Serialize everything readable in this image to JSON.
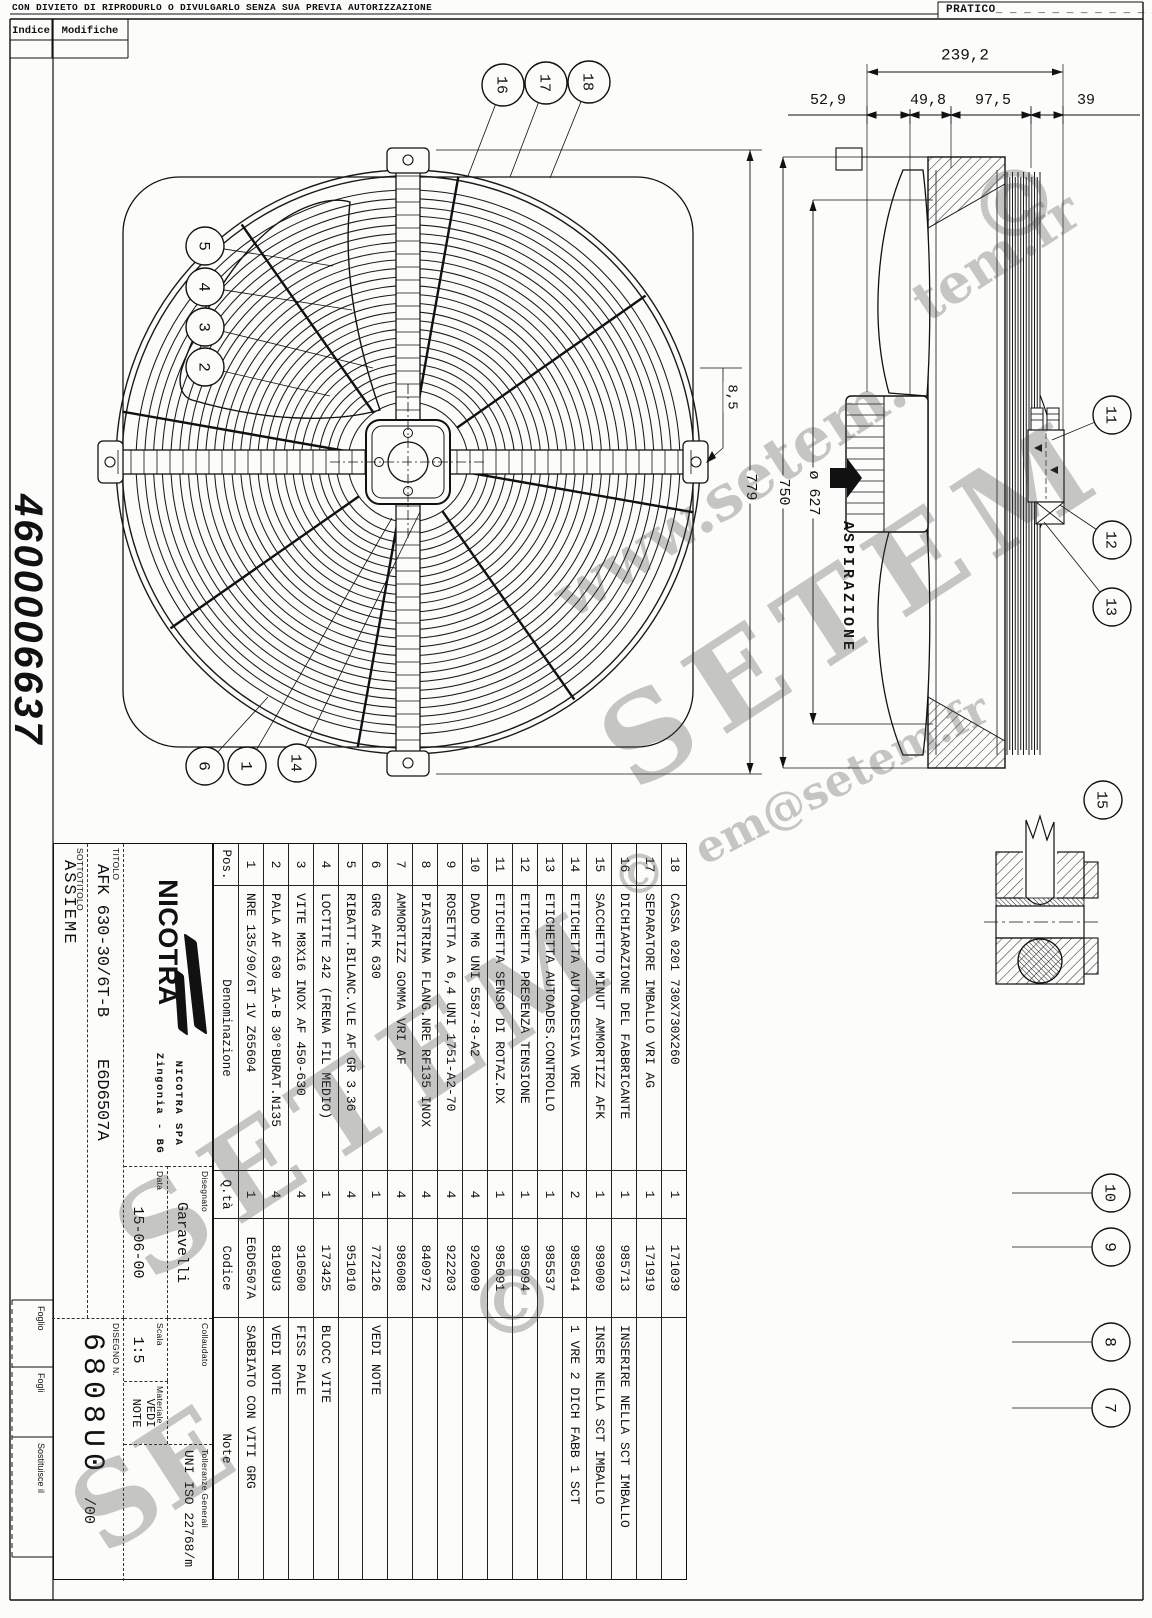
{
  "sheet": {
    "disclaimer": "CON DIVIETO DI RIPRODURLO O DIVULGARLO SENZA SUA PREVIA AUTORIZZAZIONE",
    "pratico": "PRATICO_ _ _ _ _ _ _ _ _ _ _ _",
    "indice_header": "Indice",
    "modifiche_header": "Modifiche",
    "drawing_number_side": "4600006637",
    "foglio_label": "Foglio",
    "fogli_label": "Fogli",
    "sostituisce_label": "Sostituisce il"
  },
  "views": {
    "aspirazione_label": "ASPIRAZIONE"
  },
  "dimensions": [
    {
      "text": "239,2",
      "x": 965,
      "y": 56,
      "rot": 0,
      "size": 16
    },
    {
      "text": "52,9",
      "x": 828,
      "y": 101,
      "rot": 0,
      "size": 15
    },
    {
      "text": "49,8",
      "x": 928,
      "y": 101,
      "rot": 0,
      "size": 15
    },
    {
      "text": "97,5",
      "x": 993,
      "y": 101,
      "rot": 0,
      "size": 15
    },
    {
      "text": "39",
      "x": 1086,
      "y": 101,
      "rot": 0,
      "size": 15
    },
    {
      "text": "779",
      "x": 750,
      "y": 487,
      "rot": 90,
      "size": 15
    },
    {
      "text": "750",
      "x": 783,
      "y": 492,
      "rot": 90,
      "size": 15
    },
    {
      "text": "ø 627",
      "x": 813,
      "y": 493,
      "rot": 90,
      "size": 15
    },
    {
      "text": "8,5",
      "x": 731,
      "y": 397,
      "rot": 90,
      "size": 14
    }
  ],
  "balloons": [
    {
      "n": "1",
      "x": 247,
      "y": 766,
      "tx": 392,
      "ty": 518
    },
    {
      "n": "2",
      "x": 205,
      "y": 367,
      "tx": 330,
      "ty": 396
    },
    {
      "n": "3",
      "x": 205,
      "y": 327,
      "tx": 373,
      "ty": 368
    },
    {
      "n": "4",
      "x": 205,
      "y": 287,
      "tx": 352,
      "ty": 310
    },
    {
      "n": "5",
      "x": 205,
      "y": 246,
      "tx": 333,
      "ty": 266
    },
    {
      "n": "6",
      "x": 205,
      "y": 766,
      "tx": 268,
      "ty": 697
    },
    {
      "n": "7",
      "x": 1111,
      "y": 1408,
      "tx": 1012,
      "ty": 1408
    },
    {
      "n": "8",
      "x": 1111,
      "y": 1342,
      "tx": 1012,
      "ty": 1342
    },
    {
      "n": "9",
      "x": 1111,
      "y": 1247,
      "tx": 1012,
      "ty": 1247
    },
    {
      "n": "10",
      "x": 1111,
      "y": 1193,
      "tx": 1012,
      "ty": 1193
    },
    {
      "n": "11",
      "x": 1112,
      "y": 415,
      "tx": 1052,
      "ty": 440
    },
    {
      "n": "12",
      "x": 1112,
      "y": 540,
      "tx": 1060,
      "ty": 505
    },
    {
      "n": "13",
      "x": 1112,
      "y": 607,
      "tx": 1044,
      "ty": 522
    },
    {
      "n": "14",
      "x": 297,
      "y": 763,
      "tx": 420,
      "ty": 512
    },
    {
      "n": "15",
      "x": 1103,
      "y": 800
    },
    {
      "n": "16",
      "x": 503,
      "y": 85,
      "tx": 468,
      "ty": 176,
      "r": 21
    },
    {
      "n": "17",
      "x": 546,
      "y": 83,
      "tx": 510,
      "ty": 177,
      "r": 21
    },
    {
      "n": "18",
      "x": 589,
      "y": 82,
      "tx": 550,
      "ty": 178,
      "r": 21
    }
  ],
  "bom": {
    "headers": {
      "pos": "Pos.",
      "den": "Denominazione",
      "qty": "Q.tà",
      "code": "Codice",
      "note": "Note"
    },
    "rows": [
      {
        "pos": "1",
        "den": "NRE 135/90/6T 1V Z65604",
        "qty": "1",
        "code": "E6D6507A",
        "note": "SABBIATO CON VITI GRG"
      },
      {
        "pos": "2",
        "den": "PALA AF 630 1A-B 30°BURAT.N135",
        "qty": "4",
        "code": "8109U3",
        "note": "VEDI NOTE"
      },
      {
        "pos": "3",
        "den": "VITE M8X16 INOX AF 450-630",
        "qty": "4",
        "code": "910500",
        "note": "FISS PALE"
      },
      {
        "pos": "4",
        "den": "LOCTITE 242 (FRENA FIL MEDIO)",
        "qty": "1",
        "code": "173425",
        "note": "BLOCC VITE"
      },
      {
        "pos": "5",
        "den": "RIBATT.BILANC.VLE AF GR 3.36",
        "qty": "4",
        "code": "951010",
        "note": ""
      },
      {
        "pos": "6",
        "den": "GRG AFK 630",
        "qty": "1",
        "code": "772126",
        "note": "VEDI NOTE"
      },
      {
        "pos": "7",
        "den": "AMMORTIZZ GOMMA VRI AF",
        "qty": "4",
        "code": "986008",
        "note": ""
      },
      {
        "pos": "8",
        "den": "PIASTRINA FLANG.NRE RF135 INOX",
        "qty": "4",
        "code": "840972",
        "note": ""
      },
      {
        "pos": "9",
        "den": "ROSETTA A 6,4 UNI 1751-A2-70",
        "qty": "4",
        "code": "922203",
        "note": ""
      },
      {
        "pos": "10",
        "den": "DADO M6 UNI 5587-8-A2",
        "qty": "4",
        "code": "920009",
        "note": ""
      },
      {
        "pos": "11",
        "den": "ETICHETTA SENSO DI ROTAZ.DX",
        "qty": "1",
        "code": "985091",
        "note": ""
      },
      {
        "pos": "12",
        "den": "ETICHETTA PRESENZA TENSIONE",
        "qty": "1",
        "code": "985094",
        "note": ""
      },
      {
        "pos": "13",
        "den": "ETICHETTA AUTOADES.CONTROLLO",
        "qty": "1",
        "code": "985537",
        "note": ""
      },
      {
        "pos": "14",
        "den": "ETICHETTA AUTOADESIVA VRE",
        "qty": "2",
        "code": "985014",
        "note": "1 VRE 2 DICH FABB 1 SCT"
      },
      {
        "pos": "15",
        "den": "SACCHETTO MINUT AMMORTIZZ AFK",
        "qty": "1",
        "code": "989009",
        "note": "INSER NELLA SCT IMBALLO"
      },
      {
        "pos": "16",
        "den": "DICHIARAZIONE DEL FABBRICANTE",
        "qty": "1",
        "code": "985713",
        "note": "INSERIRE NELLA SCT IMBALLO"
      },
      {
        "pos": "17",
        "den": "SEPARATORE IMBALLO VRI AG",
        "qty": "1",
        "code": "171919",
        "note": ""
      },
      {
        "pos": "18",
        "den": "CASSA 0201 730X730X260",
        "qty": "1",
        "code": "171039",
        "note": ""
      }
    ]
  },
  "title_block": {
    "logo_text": "NICOTRA",
    "company": "NICOTRA  SPA",
    "city": "Zingonia - BG",
    "disegnato_label": "Disegnato",
    "disegnato": "Garavelli",
    "collaudato_label": "Collaudato",
    "tolleranze_label": "Tolleranze Generali",
    "tolleranze": "UNI ISO 22768/m",
    "data_label": "Data",
    "data": "15-06-00",
    "scala_label": "Scala",
    "scala": "1:5",
    "materiale_label": "Materiale",
    "materiale": "VEDI NOTE",
    "titolo_label": "TITOLO",
    "titolo": "AFK 630-30/6T-B",
    "titolo_code": "E6D6507A",
    "sottotitolo_label": "SOTTOTITOLO",
    "sottotitolo": "ASSIEME",
    "disegno_label": "DISEGNO N.",
    "disegno": "6808U0",
    "revisione": "/00"
  },
  "watermarks": [
    {
      "text": "www.setem.",
      "x": 540,
      "y": 572,
      "size": 62,
      "rot": -33
    },
    {
      "text": "SETEM",
      "x": 575,
      "y": 700,
      "size": 118,
      "rot": -33,
      "ls": 18
    },
    {
      "text": "em@setem.fr",
      "x": 686,
      "y": 830,
      "size": 44,
      "rot": -27
    },
    {
      "text": "SETEM",
      "x": 90,
      "y": 1190,
      "size": 118,
      "rot": -33,
      "ls": 18
    },
    {
      "text": "SE",
      "x": 48,
      "y": 1470,
      "size": 110,
      "rot": -33
    },
    {
      "text": "tem.fr",
      "x": 900,
      "y": 280,
      "size": 54,
      "rot": -33
    },
    {
      "text": "©",
      "x": 968,
      "y": 150,
      "size": 92,
      "rot": 0
    },
    {
      "text": "©",
      "x": 612,
      "y": 842,
      "size": 54,
      "rot": 0
    },
    {
      "text": "©",
      "x": 468,
      "y": 1250,
      "size": 88,
      "rot": 0
    }
  ]
}
